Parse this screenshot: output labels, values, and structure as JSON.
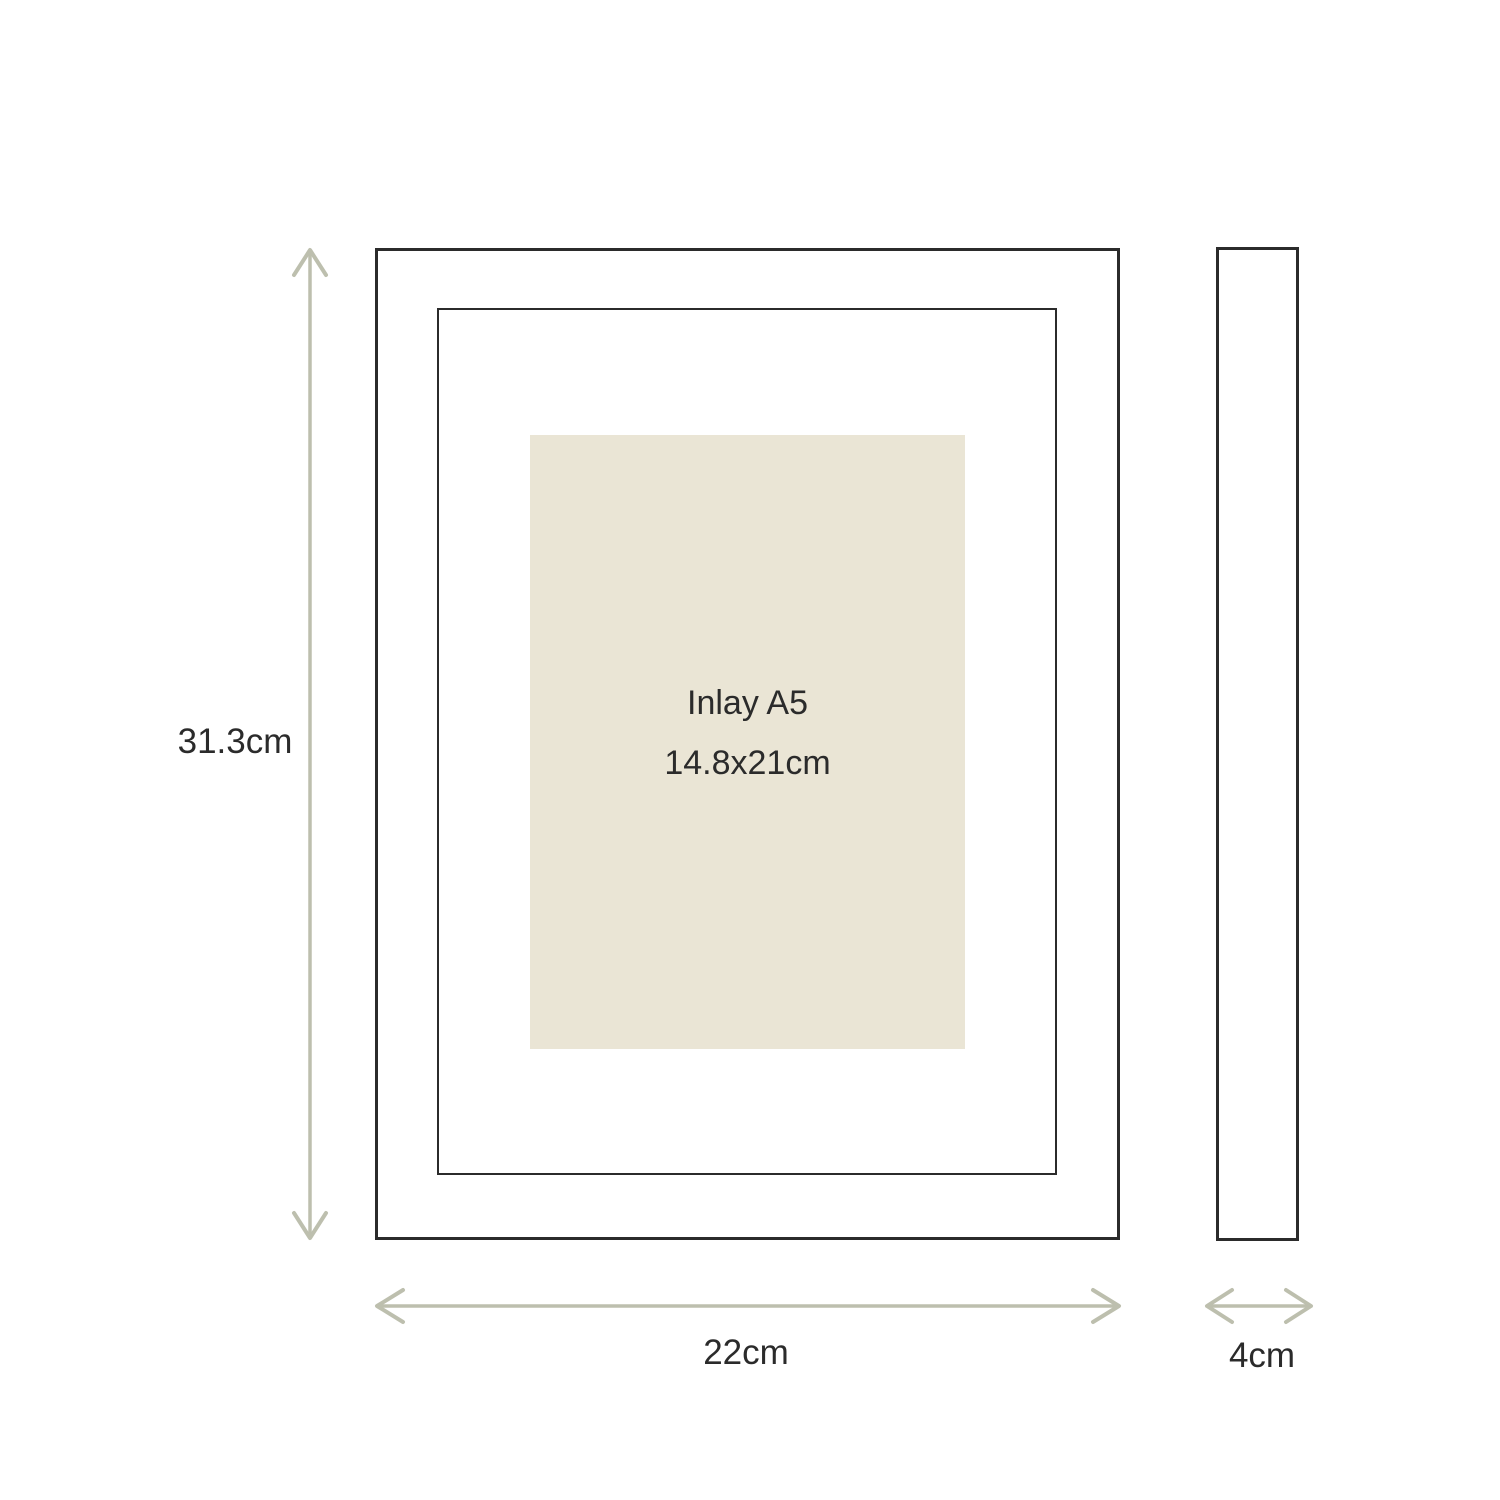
{
  "inlay": {
    "title": "Inlay A5",
    "size": "14.8x21cm"
  },
  "dimensions": {
    "height": "31.3cm",
    "width": "22cm",
    "depth": "4cm"
  },
  "colors": {
    "background": "#ffffff",
    "outline": "#2b2b2b",
    "dimension_arrow": "#bdbfae",
    "inlay_fill": "#eae5d5",
    "text": "#2b2b2b"
  }
}
